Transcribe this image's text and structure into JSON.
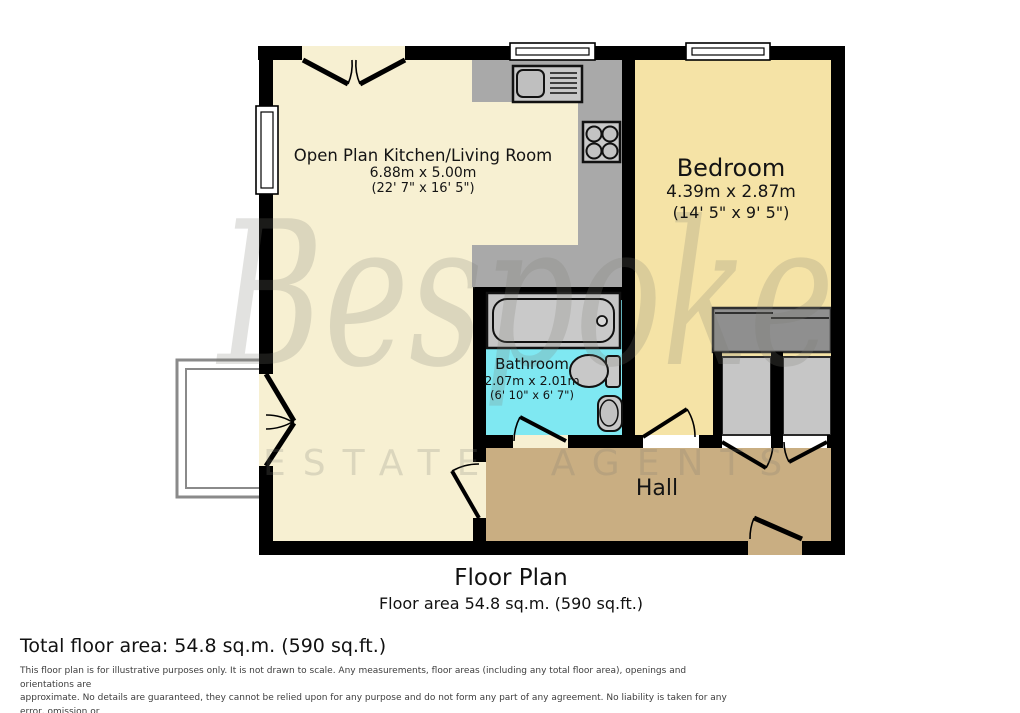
{
  "watermark": {
    "brand": "Bespoke",
    "tagline": "ESTATE AGENTS"
  },
  "rooms": {
    "living": {
      "name": "Open Plan Kitchen/Living Room",
      "size_metric": "6.88m x 5.00m",
      "size_imperial": "(22' 7\" x 16' 5\")"
    },
    "bedroom": {
      "name": "Bedroom",
      "size_metric": "4.39m x 2.87m",
      "size_imperial": "(14' 5\" x 9' 5\")"
    },
    "bathroom": {
      "name": "Bathroom",
      "size_metric": "2.07m x 2.01m",
      "size_imperial": "(6' 10\" x 6' 7\")"
    },
    "hall": {
      "name": "Hall"
    }
  },
  "footer": {
    "title": "Floor Plan",
    "subtitle": "Floor area 54.8 sq.m. (590 sq.ft.)",
    "total_area": "Total floor area: 54.8 sq.m. (590 sq.ft.)",
    "disclaimer": [
      "This floor plan is for illustrative purposes only. It is not drawn to scale. Any measurements, floor areas (including any total floor area), openings and orientations are",
      "approximate. No details are guaranteed, they cannot be relied upon for any purpose and do not form any part of any agreement. No liability is taken for any error, omission or",
      "misstatement. A party must rely upon its own inspection(s). Powered by www.Propertybox.io"
    ]
  },
  "colors": {
    "wall": "#000000",
    "living_room_fill": "#F7F0D2",
    "bedroom_fill": "#F5E3A6",
    "bathroom_fill": "#7FE8F2",
    "hall_fill": "#C9AE82",
    "counter_fill": "#A9A9A9",
    "closet_fill": "#C6C6C6",
    "wardrobe_fill": "#8F8F8F",
    "fixture_fill": "#C8C8C8",
    "watermark_grey": "#E4E4E0"
  }
}
